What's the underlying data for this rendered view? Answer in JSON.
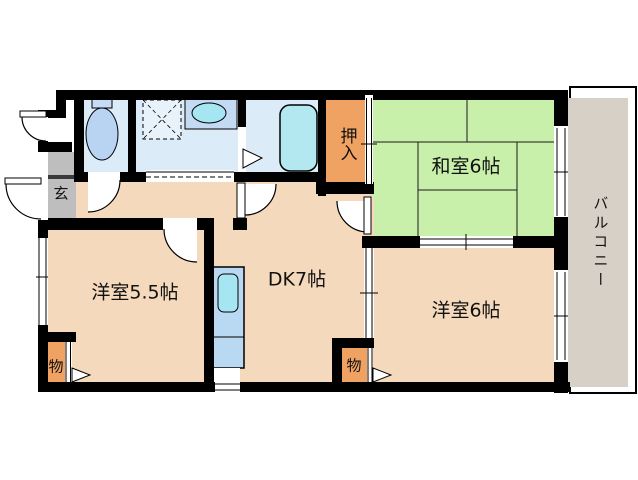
{
  "labels": {
    "washitsu": "和室6帖",
    "dk": "DK7帖",
    "western_5_5": "洋室5.5帖",
    "western_6": "洋室6帖",
    "oshiire": "押入",
    "balcony": "バルコニー",
    "genkan": "玄",
    "storage_left": "物",
    "storage_right": "物"
  },
  "colors": {
    "tatami_green": "#c9f0ab",
    "floor_peach": "#f5d9bc",
    "closet_orange": "#f0a262",
    "genkan_gray": "#bebebe",
    "genkan_step": "#3a3a3a",
    "balcony_tan": "#d7d0c7",
    "sanitary_blue": "#dcebf8",
    "counter_blue": "#c4daf2",
    "fixture_blue": "#b9d9f2",
    "sink_cyan": "#a6e6f2",
    "tub_cyan": "#b4e8f0",
    "washer_pad": "#e8f2fb",
    "wall_black": "#000000"
  }
}
